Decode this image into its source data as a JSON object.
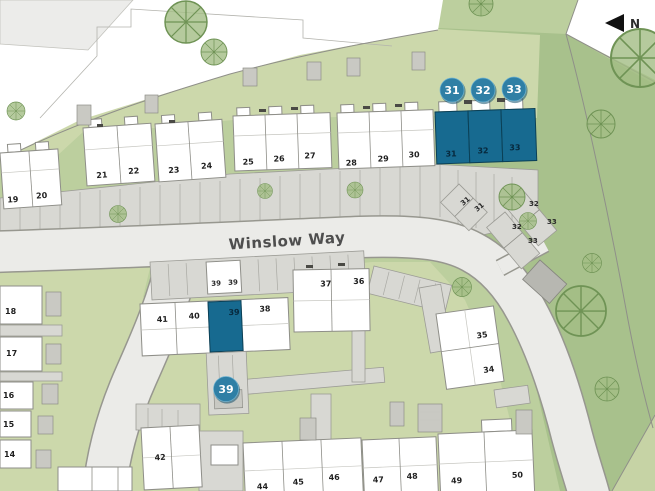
{
  "map": {
    "road_name": "Winslow Way",
    "north_label": "N"
  },
  "plot_labels": {
    "p14": "14",
    "p15": "15",
    "p16": "16",
    "p17": "17",
    "p18": "18",
    "p19": "19",
    "p20": "20",
    "p21": "21",
    "p22": "22",
    "p23": "23",
    "p24": "24",
    "p25": "25",
    "p26": "26",
    "p27": "27",
    "p28": "28",
    "p29": "29",
    "p30": "30",
    "p31": "31",
    "p32": "32",
    "p33": "33",
    "p34": "34",
    "p35": "35",
    "p36": "36",
    "p37": "37",
    "p38": "38",
    "p39": "39",
    "p40": "40",
    "p41": "41",
    "p42": "42",
    "p44": "44",
    "p45": "45",
    "p46": "46",
    "p47": "47",
    "p48": "48",
    "p49": "49",
    "p50": "50"
  },
  "badges": {
    "b31": "31",
    "b32": "32",
    "b33": "33",
    "b39": "39"
  },
  "highlighted_plots": [
    "31",
    "32",
    "33",
    "39"
  ],
  "colors": {
    "highlight_teal": "#176a90",
    "badge_teal": "#2f7fa5",
    "garden_green": "#ccd8ab",
    "landscape_green": "#a8c18c",
    "base_green": "#bccf9e",
    "road_fill": "#ebebe8",
    "driveway_gray": "#d8d8d3",
    "building_white": "#ffffff"
  }
}
